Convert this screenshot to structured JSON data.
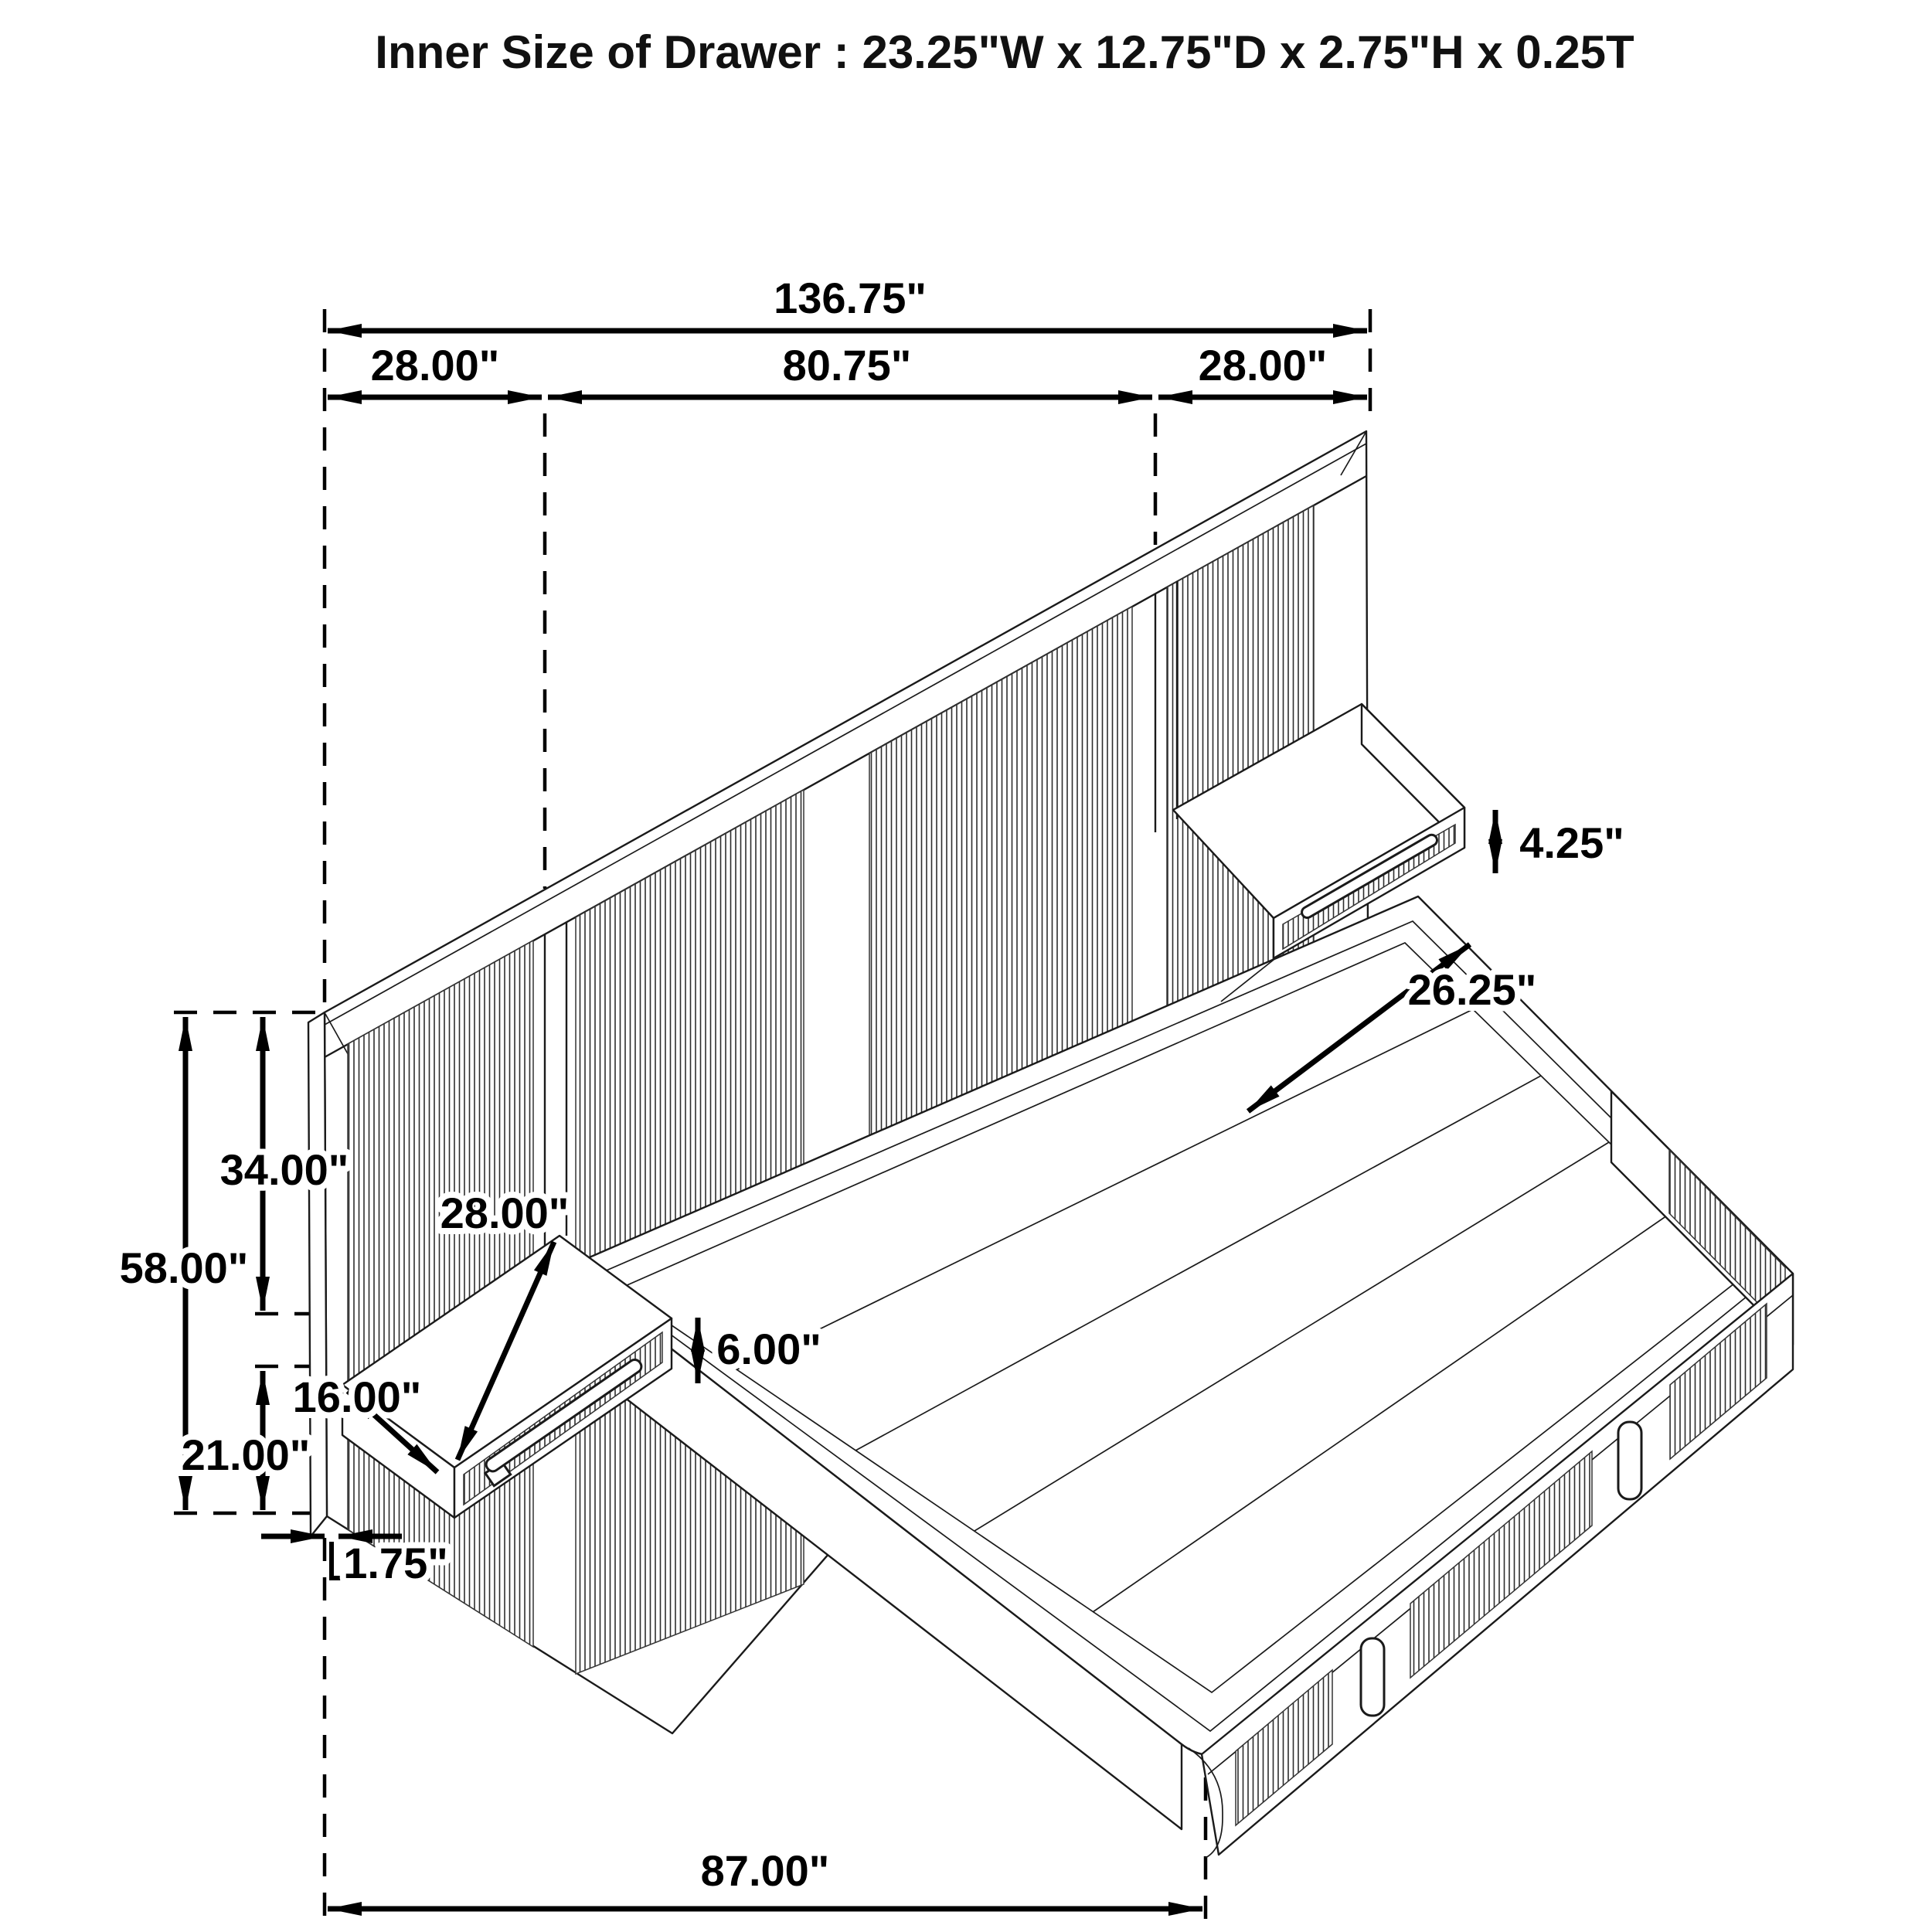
{
  "title": "Inner Size of Drawer : 23.25\"W x 12.75\"D x 2.75\"H x 0.25T",
  "diagram": {
    "type": "isometric-furniture-dimension-drawing",
    "subject": "wall-panel platform bed with floating nightstands",
    "dimensions": {
      "overall_width": {
        "label": "136.75\""
      },
      "left_panel_width": {
        "label": "28.00\""
      },
      "center_panel_width": {
        "label": "80.75\""
      },
      "right_panel_width": {
        "label": "28.00\""
      },
      "right_nightstand_height": {
        "label": "4.25\""
      },
      "right_nightstand_width": {
        "label": "26.25\""
      },
      "headboard_upper_height": {
        "label": "34.00\""
      },
      "headboard_total_height": {
        "label": "58.00\""
      },
      "left_nightstand_width": {
        "label": "28.00\""
      },
      "left_nightstand_height": {
        "label": "6.00\""
      },
      "left_nightstand_depth": {
        "label": "16.00\""
      },
      "under_panel_height": {
        "label": "21.00\""
      },
      "panel_thickness": {
        "label": "1.75\""
      },
      "bed_length": {
        "label": "87.00\""
      }
    },
    "colors": {
      "line": "#1a1a1a",
      "dimension": "#000000",
      "background": "#ffffff"
    }
  }
}
